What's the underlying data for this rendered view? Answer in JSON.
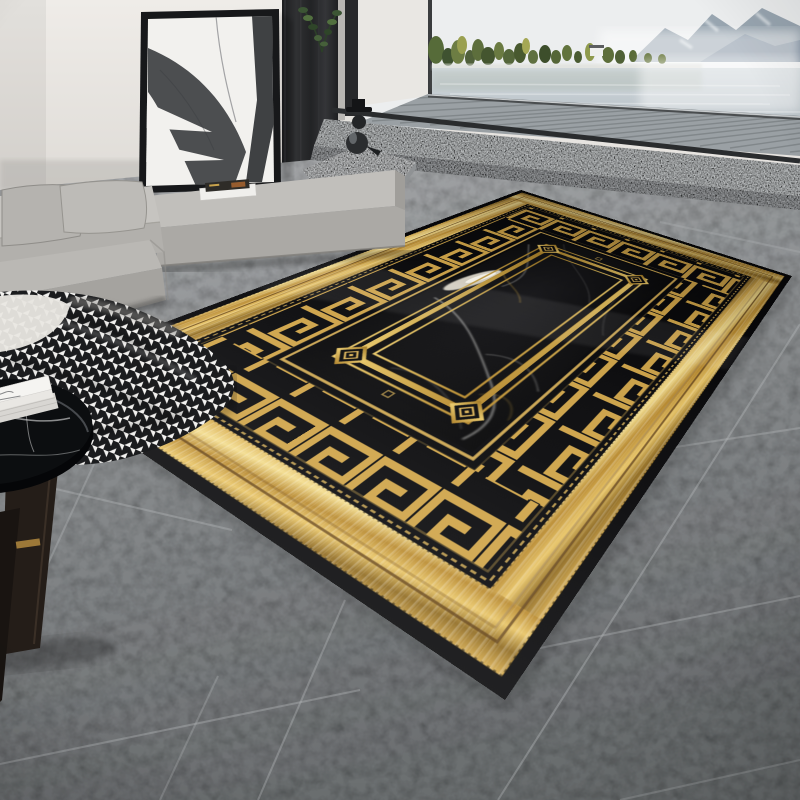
{
  "scene": {
    "domain": "natural-image",
    "subject": "Modern living room product photo of a black and gold Greek-key marble-print area rug",
    "setting": "floor-to-ceiling opening with foggy lake and mountain view"
  },
  "palette": {
    "wall": "#e9e6e2",
    "pillar_wood": "#2a2b2d",
    "sofa_fabric": "#b8b6b2",
    "floor_tile": "#85888a",
    "grout": "#b3b6b8",
    "rug_black": "#0a0a0c",
    "rug_gold": "#d2a64b",
    "gold_bright": "#f3dc8c",
    "gold_deep": "#7a5a1c",
    "pinstripe_brown": "#5b3a10",
    "water": "#c8d0d5",
    "mountain": "#8b99a6",
    "tree_green": "#566b39",
    "granite": "#c0c3c4",
    "blanket_white": "#f2f1ef",
    "blanket_black": "#1b1c1e",
    "marble_vein": "#e6e6e2"
  },
  "objects": {
    "artwork": {
      "label": "abstract ink painting leaning on wall",
      "frame": "black",
      "canvas": "off-white"
    },
    "plant": {
      "label": "green branch behind art"
    },
    "window_view": {
      "label": "lake with fog",
      "elements": [
        "mountain ridges",
        "shoreline trees",
        "white lake house",
        "water reflections",
        "mist"
      ]
    },
    "deck": {
      "label": "outdoor slatted deck"
    },
    "step": {
      "label": "granite step"
    },
    "sculpture": {
      "label": "black bird figurine on granite wedge"
    },
    "sofa": {
      "label": "gray fabric modular sofa",
      "pillow_count": 2,
      "magazines_on_seat": 2
    },
    "blanket": {
      "label": "houndstooth throw blanket"
    },
    "side_table": {
      "label": "round black marble side table",
      "items": [
        "white book stack"
      ]
    },
    "floor": {
      "label": "gray stone tile floor"
    },
    "rug": {
      "label": "black and gold greca border rug",
      "border": [
        "black binding",
        "metallic gold band",
        "greek-key meander band",
        "gold pinline"
      ],
      "field": "black marble print with white and gold veins",
      "inner_frame": "triple gold line frame with diamond corner medallions"
    }
  }
}
